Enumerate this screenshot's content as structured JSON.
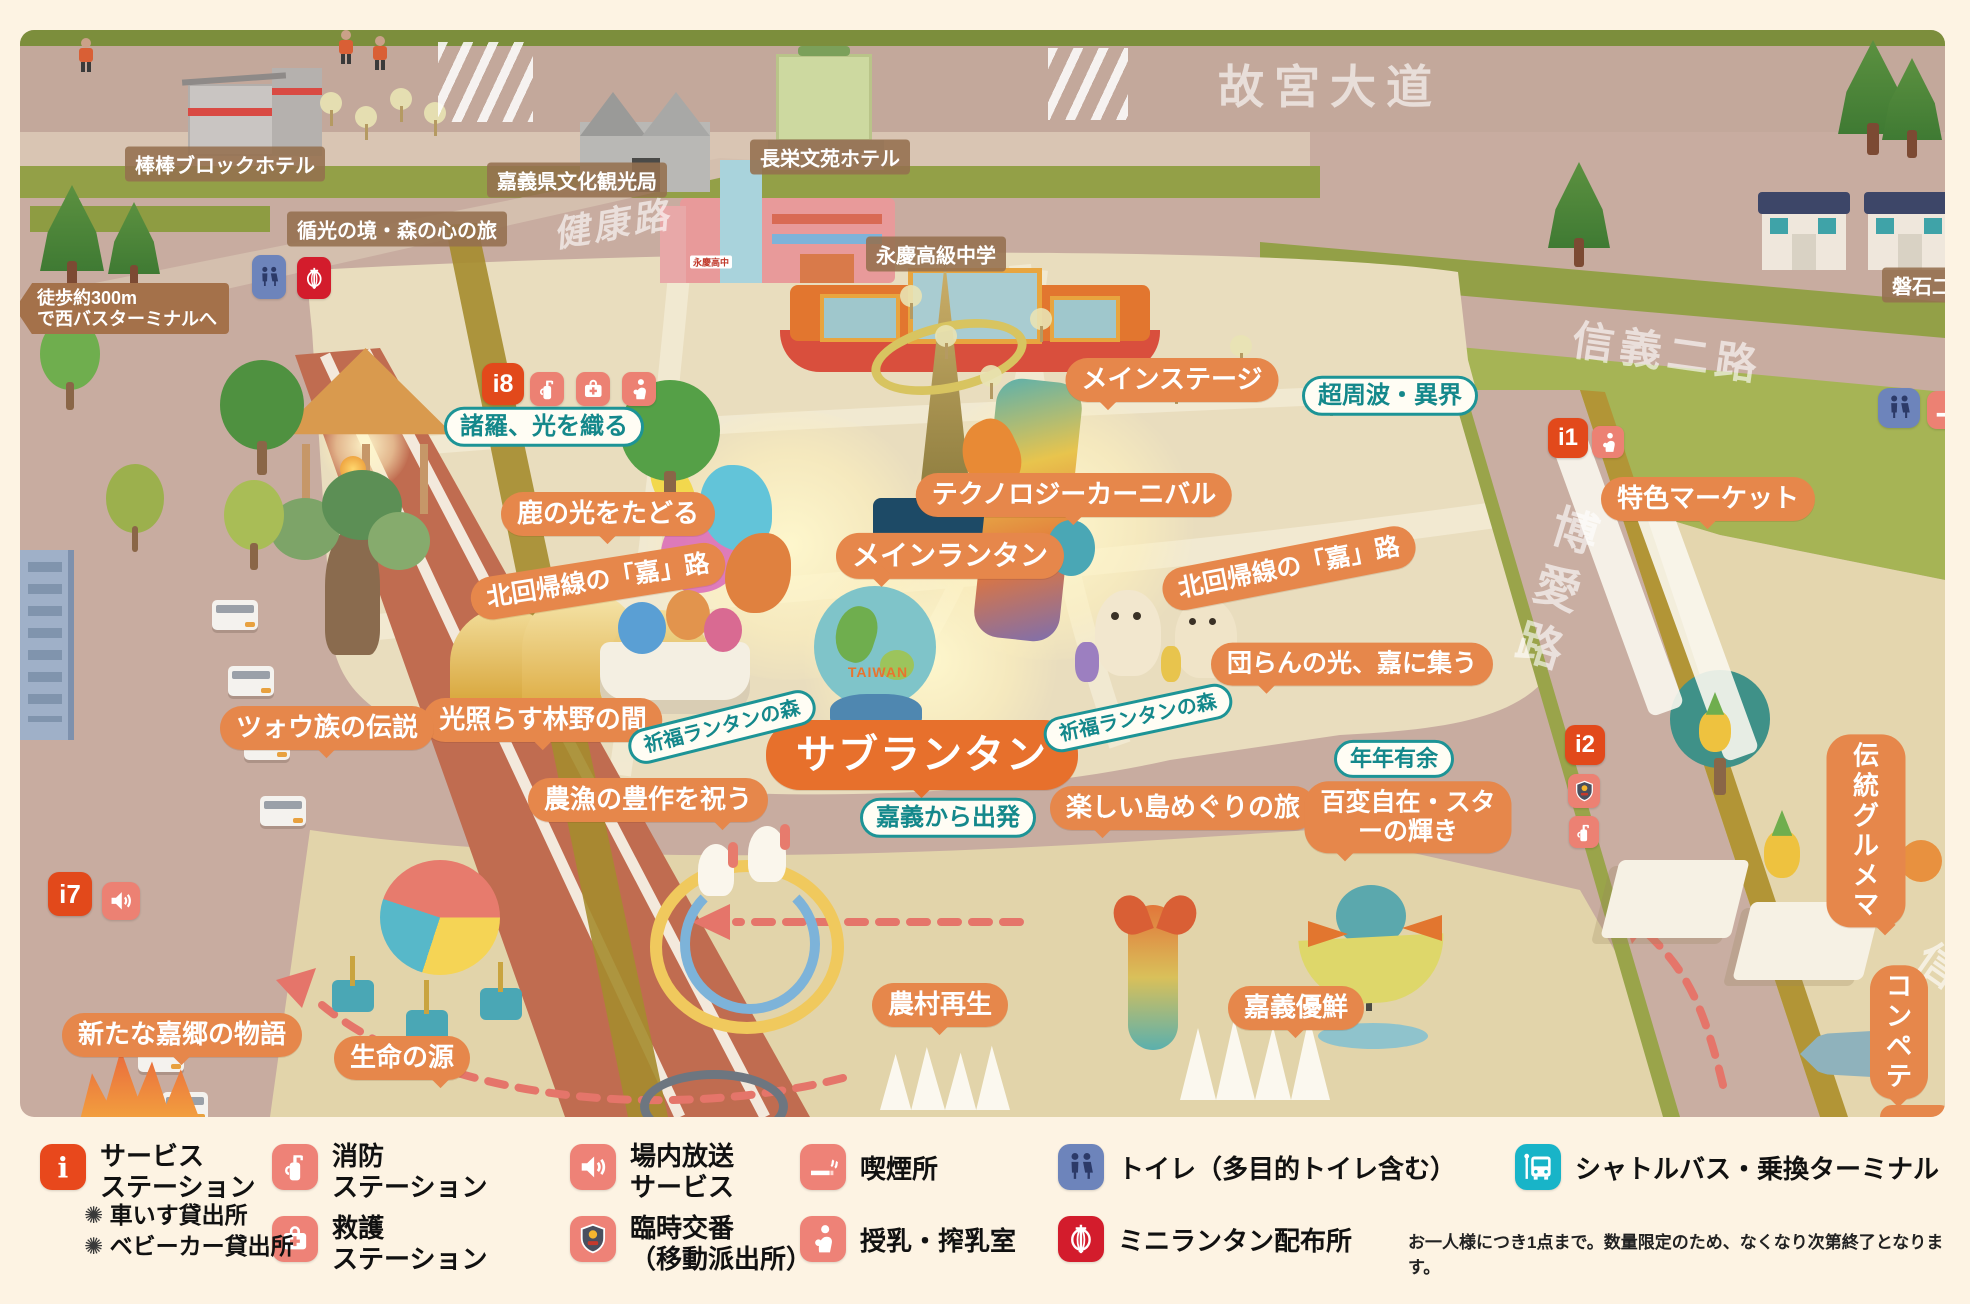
{
  "colors": {
    "accent_orange": "#e6874b",
    "deep_orange": "#e7702c",
    "teal": "#1d9496",
    "marker_red": "#e2491b",
    "salmon": "#ec8173",
    "toilet_blue": "#6d84bb",
    "lantern_red": "#d31c2c",
    "bus_teal": "#18b4c8",
    "brown_label": "#96704f",
    "cream": "#fdf3e3"
  },
  "map": {
    "road_labels": [
      {
        "id": "gugong-blvd",
        "label": "故宮大道",
        "x": 1330,
        "y": 84,
        "fs": 46,
        "ls": 10,
        "rot": 0
      },
      {
        "id": "jiankang-rd",
        "label": "健康路",
        "x": 612,
        "y": 222,
        "fs": 36,
        "ls": 4,
        "rot": -10,
        "italic": true
      },
      {
        "id": "xinyi-2nd-rd",
        "label": "信義二路",
        "x": 1668,
        "y": 350,
        "fs": 42,
        "ls": 6,
        "rot": 8
      },
      {
        "id": "boai-rd",
        "label": "博愛路",
        "x": 1553,
        "y": 593,
        "fs": 46,
        "ls": 14,
        "rot": 17,
        "vertical": true
      },
      {
        "id": "xinyi-partial",
        "label": "信",
        "x": 1940,
        "y": 963,
        "fs": 42,
        "ls": 0,
        "rot": 35
      }
    ],
    "place_labels": [
      {
        "id": "block-hotel",
        "label": "棒棒ブロックホテル",
        "x": 225,
        "y": 164
      },
      {
        "id": "culture-bureau",
        "label": "嘉義県文化観光局",
        "x": 577,
        "y": 180
      },
      {
        "id": "wenyuan-hotel",
        "label": "長栄文苑ホテル",
        "x": 830,
        "y": 157
      },
      {
        "id": "yongqing-school",
        "label": "永慶高級中学",
        "x": 936,
        "y": 254
      },
      {
        "id": "light-forest-journey",
        "label": "循光の境・森の心の旅",
        "x": 397,
        "y": 229
      },
      {
        "id": "panshi",
        "label": "磐石二",
        "x": 1922,
        "y": 285
      }
    ],
    "walk_label": {
      "label": "徒歩約300m\nで西バスターミナルへ",
      "x": 15,
      "y": 283
    },
    "attraction_labels": [
      {
        "label": "メインステージ",
        "x": 1172,
        "y": 380,
        "fs": 26,
        "tail": "bl"
      },
      {
        "label": "テクノロジーカーニバル",
        "x": 1074,
        "y": 495,
        "fs": 26,
        "tail": "bc"
      },
      {
        "label": "メインランタン",
        "x": 950,
        "y": 556,
        "fs": 28,
        "tail": "bl"
      },
      {
        "label": "サブランタン",
        "x": 922,
        "y": 755,
        "fs": 40,
        "tail": "bc",
        "big": true
      },
      {
        "label": "鹿の光をたどる",
        "x": 608,
        "y": 514,
        "fs": 26,
        "tail": "bc"
      },
      {
        "label": "北回帰線の「嘉」路",
        "x": 598,
        "y": 581,
        "fs": 25,
        "tail": "no",
        "rot": -9
      },
      {
        "label": "光照らす林野の間",
        "x": 543,
        "y": 720,
        "fs": 26,
        "tail": "bc"
      },
      {
        "label": "農漁の豊作を祝う",
        "x": 648,
        "y": 800,
        "fs": 26,
        "tail": "br"
      },
      {
        "label": "北回帰線の「嘉」路",
        "x": 1289,
        "y": 568,
        "fs": 25,
        "tail": "no",
        "rot": -11
      },
      {
        "label": "団らんの光、嘉に集う",
        "x": 1352,
        "y": 664,
        "fs": 25,
        "tail": "bl"
      },
      {
        "label": "楽しい島めぐりの旅",
        "x": 1183,
        "y": 808,
        "fs": 26,
        "tail": "bl"
      },
      {
        "label": "百変自在・スタ\nーの輝き",
        "x": 1408,
        "y": 817,
        "fs": 25,
        "tail": "bl"
      },
      {
        "label": "特色マーケット",
        "x": 1708,
        "y": 499,
        "fs": 26,
        "tail": "bc"
      },
      {
        "label": "伝統グルメマ",
        "x": 1866,
        "y": 831,
        "fs": 26,
        "tail": "br"
      },
      {
        "label": "ツォウ族の伝説",
        "x": 327,
        "y": 728,
        "fs": 26,
        "tail": "bc"
      },
      {
        "label": "新たな嘉郷の物語",
        "x": 182,
        "y": 1035,
        "fs": 26,
        "tail": "bc"
      },
      {
        "label": "生命の源",
        "x": 402,
        "y": 1058,
        "fs": 26,
        "tail": "br"
      },
      {
        "label": "農村再生",
        "x": 940,
        "y": 1005,
        "fs": 26,
        "tail": "bc"
      },
      {
        "label": "嘉義優鮮",
        "x": 1296,
        "y": 1008,
        "fs": 26,
        "tail": "bc"
      },
      {
        "label": "コンペテ",
        "x": 1899,
        "y": 1032,
        "fs": 26,
        "tail": "bc"
      }
    ],
    "info_labels": [
      {
        "label": "諸羅、光を織る",
        "x": 544,
        "y": 427,
        "fs": 24
      },
      {
        "label": "超周波・異界",
        "x": 1390,
        "y": 396,
        "fs": 24
      },
      {
        "label": "祈福ランタンの森",
        "x": 722,
        "y": 727,
        "fs": 20,
        "rot": -14
      },
      {
        "label": "祈福ランタンの森",
        "x": 1138,
        "y": 718,
        "fs": 20,
        "rot": -12
      },
      {
        "label": "嘉義から出発",
        "x": 948,
        "y": 818,
        "fs": 24
      },
      {
        "label": "年年有余",
        "x": 1394,
        "y": 759,
        "fs": 22
      }
    ],
    "service_markers": [
      {
        "label": "i8",
        "x": 482,
        "y": 363,
        "s": 42
      },
      {
        "label": "i1",
        "x": 1548,
        "y": 418,
        "s": 40
      },
      {
        "label": "i2",
        "x": 1565,
        "y": 725,
        "s": 40
      },
      {
        "label": "i7",
        "x": 48,
        "y": 872,
        "s": 44
      }
    ],
    "icon_badges": [
      {
        "icon": "extinguisher",
        "x": 530,
        "y": 372,
        "w": 34,
        "h": 34
      },
      {
        "icon": "firstaid",
        "x": 576,
        "y": 372,
        "w": 34,
        "h": 34
      },
      {
        "icon": "nursing",
        "x": 622,
        "y": 372,
        "w": 34,
        "h": 34
      },
      {
        "icon": "nursing",
        "x": 1592,
        "y": 426,
        "w": 32,
        "h": 32
      },
      {
        "icon": "police",
        "x": 1568,
        "y": 774,
        "w": 32,
        "h": 34
      },
      {
        "icon": "extinguisher",
        "x": 1569,
        "y": 816,
        "w": 30,
        "h": 32
      },
      {
        "icon": "speaker",
        "x": 102,
        "y": 882,
        "w": 38,
        "h": 38
      },
      {
        "icon": "toilet",
        "x": 252,
        "y": 255,
        "w": 34,
        "h": 44,
        "color": "#6d84bb"
      },
      {
        "icon": "lantern",
        "x": 297,
        "y": 257,
        "w": 34,
        "h": 42,
        "color": "#d31c2c"
      },
      {
        "icon": "toilet",
        "x": 1878,
        "y": 388,
        "w": 42,
        "h": 40,
        "color": "#6d84bb"
      },
      {
        "icon": "smoking",
        "x": 1927,
        "y": 391,
        "w": 40,
        "h": 38
      }
    ],
    "sculpture_text": {
      "label": "TAIWAN",
      "x": 878,
      "y": 672
    },
    "school_sign": {
      "label": "永慶高中",
      "x": 711,
      "y": 262
    }
  },
  "legend": {
    "items": [
      {
        "icon": "info",
        "color": "#e8481c",
        "label": "サービス\nステーション",
        "x": 40,
        "y": 1144,
        "two": true
      },
      {
        "icon": "extinguisher",
        "color": "#ee8277",
        "label": "消防\nステーション",
        "x": 272,
        "y": 1144,
        "two": true
      },
      {
        "icon": "speaker",
        "color": "#ee8277",
        "label": "場内放送\nサービス",
        "x": 570,
        "y": 1144,
        "two": true
      },
      {
        "icon": "smoking",
        "color": "#ee8277",
        "label": "喫煙所",
        "x": 800,
        "y": 1144
      },
      {
        "icon": "toilet",
        "color": "#6d84bb",
        "label": "トイレ（多目的トイレ含む）",
        "x": 1058,
        "y": 1144
      },
      {
        "icon": "bus",
        "color": "#18b4c8",
        "label": "シャトルバス・乗換ターミナル",
        "x": 1515,
        "y": 1144
      },
      {
        "icon": "firstaid",
        "color": "#ee8277",
        "label": "救護\nステーション",
        "x": 272,
        "y": 1216,
        "two": true
      },
      {
        "icon": "police",
        "color": "#ee8277",
        "label": "臨時交番\n（移動派出所）",
        "x": 570,
        "y": 1216,
        "two": true
      },
      {
        "icon": "nursing",
        "color": "#ee8277",
        "label": "授乳・搾乳室",
        "x": 800,
        "y": 1216
      },
      {
        "icon": "lantern",
        "color": "#d31c2c",
        "label": "ミニランタン配布所",
        "x": 1058,
        "y": 1216
      }
    ],
    "rental_bullets": [
      {
        "label": "車いす貸出所",
        "x": 84,
        "y": 1196
      },
      {
        "label": "ベビーカー貸出所",
        "x": 84,
        "y": 1227
      }
    ],
    "note": {
      "text": "お一人様につき1点まで。数量限定のため、なくなり次第終了となります。",
      "x": 1408,
      "y": 1228
    }
  }
}
